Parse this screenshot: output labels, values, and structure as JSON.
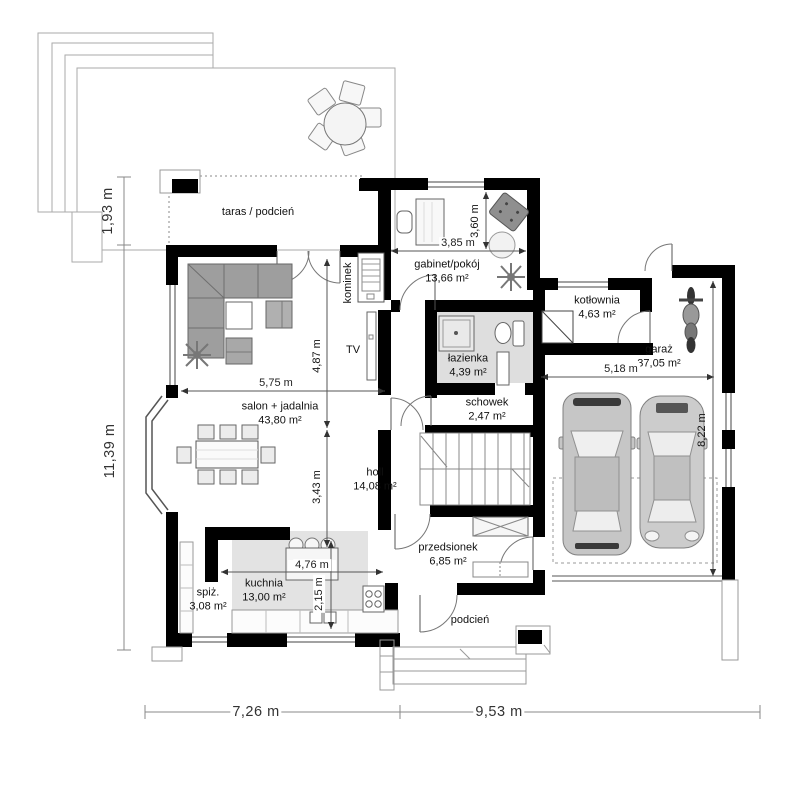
{
  "plan_title": "parter / rzut kondygnacji",
  "rooms": {
    "taras": {
      "label": "taras / podcień"
    },
    "gabinet": {
      "label": "gabinet/pokój",
      "area": "13,66 m²"
    },
    "kotlownia": {
      "label": "kotłownia",
      "area": "4,63 m²"
    },
    "garaz": {
      "label": "garaż",
      "area": "37,05 m²"
    },
    "lazienka": {
      "label": "łazienka",
      "area": "4,39 m²"
    },
    "schowek": {
      "label": "schowek",
      "area": "2,47 m²"
    },
    "salon": {
      "label": "salon + jadalnia",
      "area": "43,80 m²"
    },
    "holl": {
      "label": "holl",
      "area": "14,08 m²"
    },
    "przedsionek": {
      "label": "przedsionek",
      "area": "6,85 m²"
    },
    "kuchnia": {
      "label": "kuchnia",
      "area": "13,00 m²"
    },
    "spiz": {
      "label": "spiż.",
      "area": "3,08 m²"
    },
    "podcien": {
      "label": "podcień"
    },
    "kominek": {
      "label": "kominek"
    },
    "tv": {
      "label": "TV"
    }
  },
  "dims": {
    "terrace_depth": "1,93 m",
    "house_depth": "11,39 m",
    "house_width_left": "7,26 m",
    "house_width_right": "9,53 m",
    "gabinet_width": "3,85 m",
    "gabinet_depth": "3,60 m",
    "salon_width": "5,75 m",
    "salon_depth_a": "4,87 m",
    "salon_depth_b": "3,43 m",
    "garaz_width": "5,18 m",
    "garaz_depth": "8,22 m",
    "kuchnia_width": "4,76 m",
    "kuchnia_depth": "2,15 m"
  },
  "colors": {
    "walls": "#000000",
    "bath_floor": "#dedede",
    "kitchen_zone": "#e3e3e3",
    "sofa_gray": "#9e9e9e",
    "car_body": "#c6c6c6",
    "dashed_outline": "#999999"
  }
}
